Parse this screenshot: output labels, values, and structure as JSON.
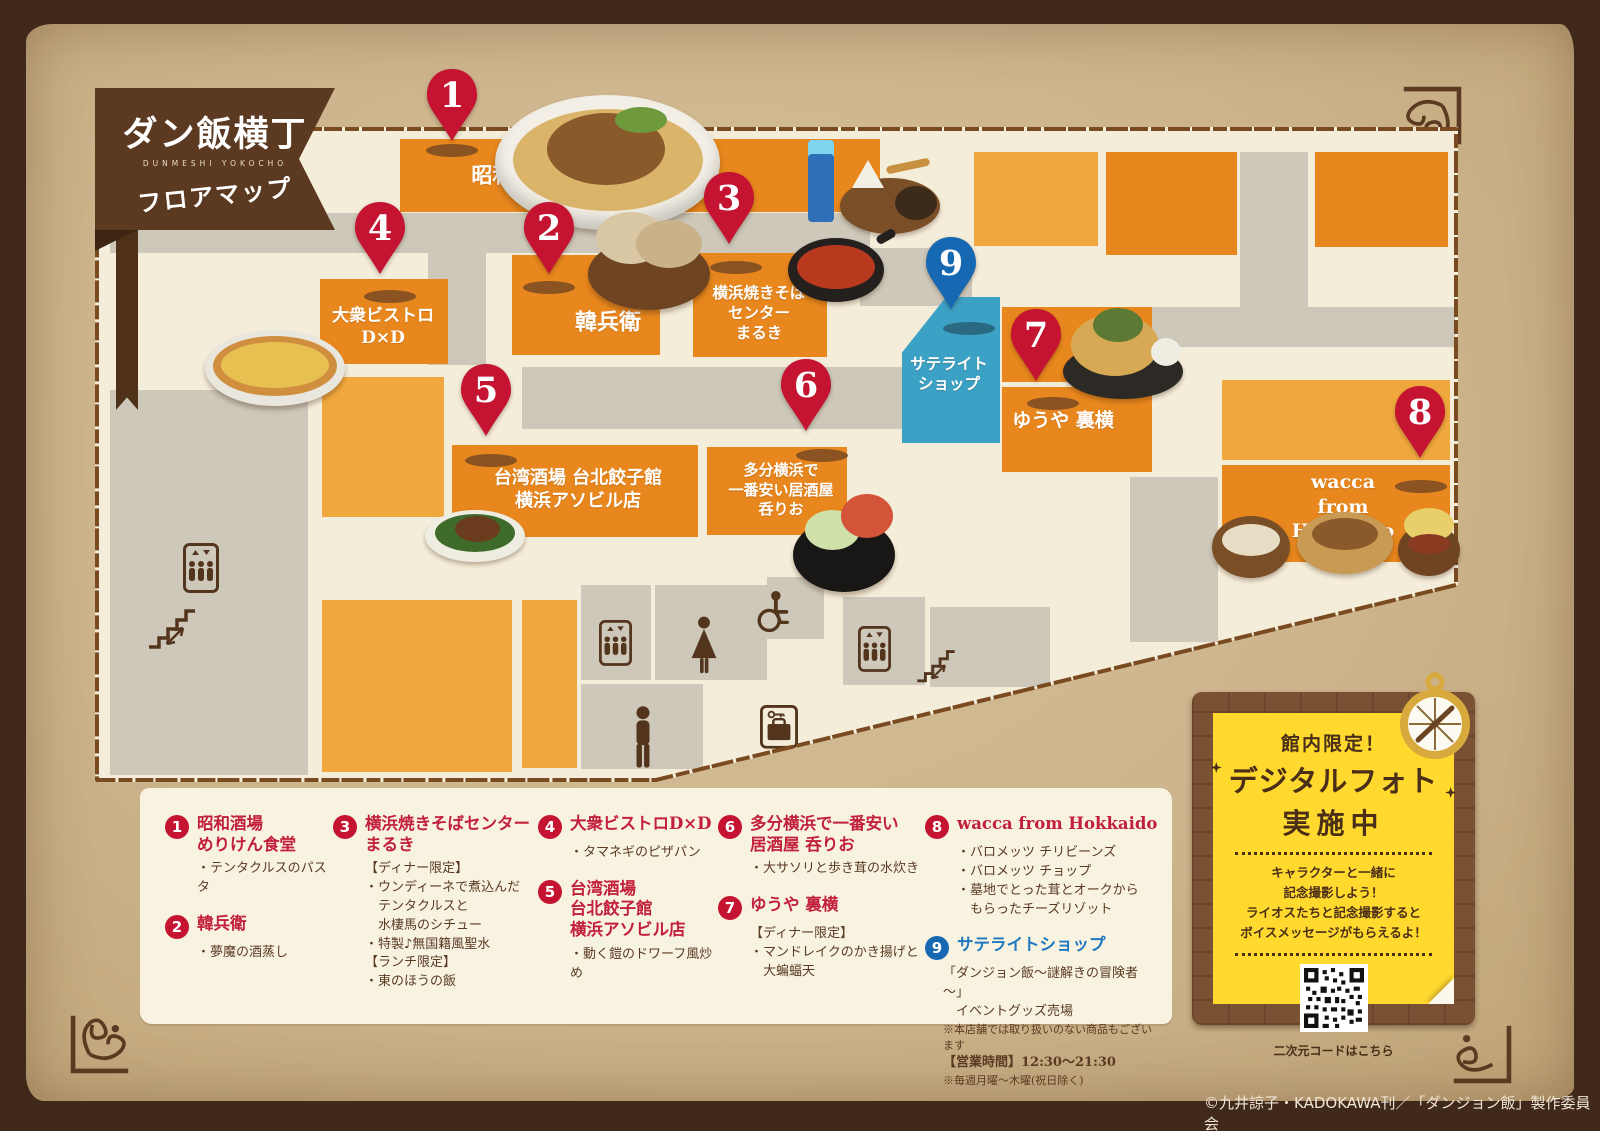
{
  "banner": {
    "title": "ダン飯横丁",
    "subtitle": "DUNMESHI YOKOCHO",
    "caption": "フロアマップ"
  },
  "map": {
    "pins": [
      "1",
      "2",
      "3",
      "4",
      "5",
      "6",
      "7",
      "8",
      "9"
    ],
    "store_labels": {
      "s1": "昭和酒場 めりけん食堂",
      "s2": "韓兵衛",
      "s3": "横浜焼きそば\nセンター\nまるき",
      "s4": "大衆ビストロ\nD×D",
      "s5": "台湾酒場 台北餃子館\n横浜アソビル店",
      "s6": "多分横浜で\n一番安い居酒屋\n呑りお",
      "s7": "ゆうや 裏横",
      "s8": "wacca from Hokkaido",
      "s9": "サテライト\nショップ"
    },
    "colors": {
      "store_orange": "#e8871d",
      "store_orange_light": "#f0a83e",
      "satellite_blue": "#3ba1c5",
      "corridor_gray": "#cdc8ba",
      "pin_red": "#c51431",
      "pin_blue": "#1668b3",
      "floor_cream": "#f4edd9"
    },
    "icons": {
      "elevator": "box with up/down arrows and three figures",
      "stairs": "staircase with two-way arrow",
      "womens_restroom": "woman figure",
      "mens_restroom": "man figure",
      "wheelchair_accessible": "wheelchair figure",
      "coin_locker": "suitcase with key",
      "compass": "compass rose"
    }
  },
  "legend": {
    "entries": [
      {
        "num": "1",
        "name": "昭和酒場\nめりけん食堂",
        "items": [
          "・テンタクルスのパスタ"
        ]
      },
      {
        "num": "2",
        "name": "韓兵衛",
        "items": [
          "・夢魔の酒蒸し"
        ]
      },
      {
        "num": "3",
        "name": "横浜焼きそばセンター\nまるき",
        "items": [
          "【ディナー限定】",
          "・ウンディーネで煮込んだ\n　テンタクルスと\n　水棲馬のシチュー",
          "・特製♪無国籍風聖水",
          "【ランチ限定】",
          "・東のほうの飯"
        ]
      },
      {
        "num": "4",
        "name": "大衆ビストロD×D",
        "items": [
          "・タマネギのピザパン"
        ]
      },
      {
        "num": "5",
        "name": "台湾酒場\n台北餃子館\n横浜アソビル店",
        "items": [
          "・動く鎧のドワーフ風炒め"
        ]
      },
      {
        "num": "6",
        "name": "多分横浜で一番安い\n居酒屋 呑りお",
        "items": [
          "・大サソリと歩き茸の水炊き"
        ]
      },
      {
        "num": "7",
        "name": "ゆうや 裏横",
        "items": [
          "【ディナー限定】",
          "・マンドレイクのかき揚げと\n　大蝙蝠天"
        ]
      },
      {
        "num": "8",
        "name": "wacca from Hokkaido",
        "items": [
          "・バロメッツ チリビーンズ",
          "・バロメッツ チョップ",
          "・墓地でとった茸とオークから\n　もらったチーズリゾット"
        ]
      },
      {
        "num": "9",
        "name": "サテライトショップ",
        "items": [
          "「ダンジョン飯～謎解きの冒険者～」\n　イベントグッズ売場",
          "※本店舗では取り扱いのない商品もございます",
          "【営業時間】12:30～21:30",
          "※毎週月曜～木曜(祝日除く)"
        ]
      }
    ]
  },
  "promo_card": {
    "limited": "館内限定！",
    "title": "デジタルフォト",
    "status": "実施中",
    "description": "キャラクターと一緒に\n記念撮影しよう！\nライオスたちと記念撮影すると\nボイスメッセージがもらえるよ！",
    "qr_caption": "二次元コードはこちら"
  },
  "copyright": "©九井諒子・KADOKAWA刊／「ダンジョン飯」製作委員会"
}
